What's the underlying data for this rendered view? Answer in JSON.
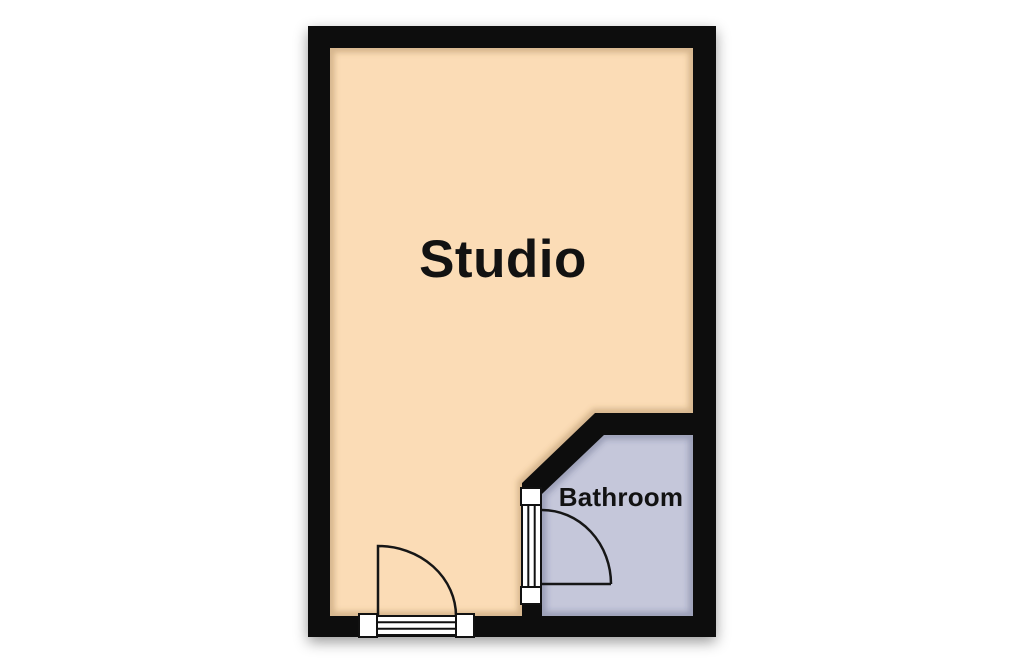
{
  "title": "Studio flat floor plan",
  "colors": {
    "background": "#ffffff",
    "wall": "#0b0b0b",
    "studio_floor": "#fbdcb6",
    "bathroom_floor": "#c5c7da",
    "door_line": "#161616",
    "threshold_fill": "#ffffff",
    "threshold_border": "#111111",
    "label_text": "#121212"
  },
  "rooms": [
    {
      "label": "Studio"
    },
    {
      "label": "Bathroom"
    }
  ]
}
